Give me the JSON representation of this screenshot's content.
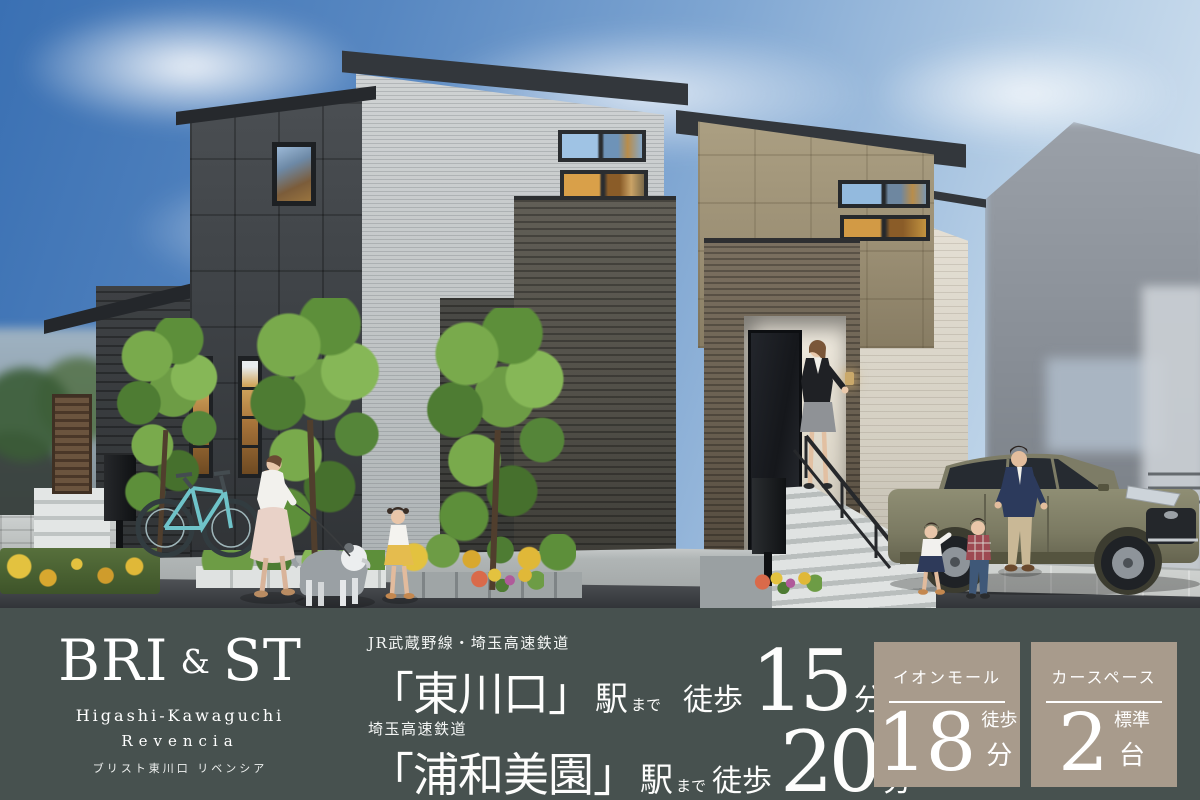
{
  "brand": {
    "logo_parts": [
      "BRI",
      "&",
      "ST"
    ],
    "name_en_line1": "Higashi-Kawaguchi",
    "name_en_line2": "Revencia",
    "name_jp": "ブリスト東川口 リベンシア"
  },
  "access": [
    {
      "railway": "JR武蔵野線・埼玉高速鉄道",
      "station": "「東川口」",
      "station_suffix": "駅",
      "to": "まで",
      "walk": "徒歩",
      "minutes": "15",
      "minutes_unit": "分"
    },
    {
      "railway": "埼玉高速鉄道",
      "station": "「浦和美園」",
      "station_suffix": "駅",
      "to": "まで",
      "walk": "徒歩",
      "minutes": "20",
      "minutes_unit": "分"
    }
  ],
  "badges": [
    {
      "title": "イオンモール",
      "value": "18",
      "unit_top": "徒歩",
      "unit_bottom": "分"
    },
    {
      "title": "カースペース",
      "value": "2",
      "unit_top": "標準",
      "unit_bottom": "台"
    }
  ],
  "colors": {
    "bar_bg": "#47514f",
    "badge_bg": "#a89b8c",
    "text": "#ffffff",
    "sky_blue": "#3a70b3",
    "suv_khaki": "#85846c",
    "accent_wood": "#6b6152"
  }
}
